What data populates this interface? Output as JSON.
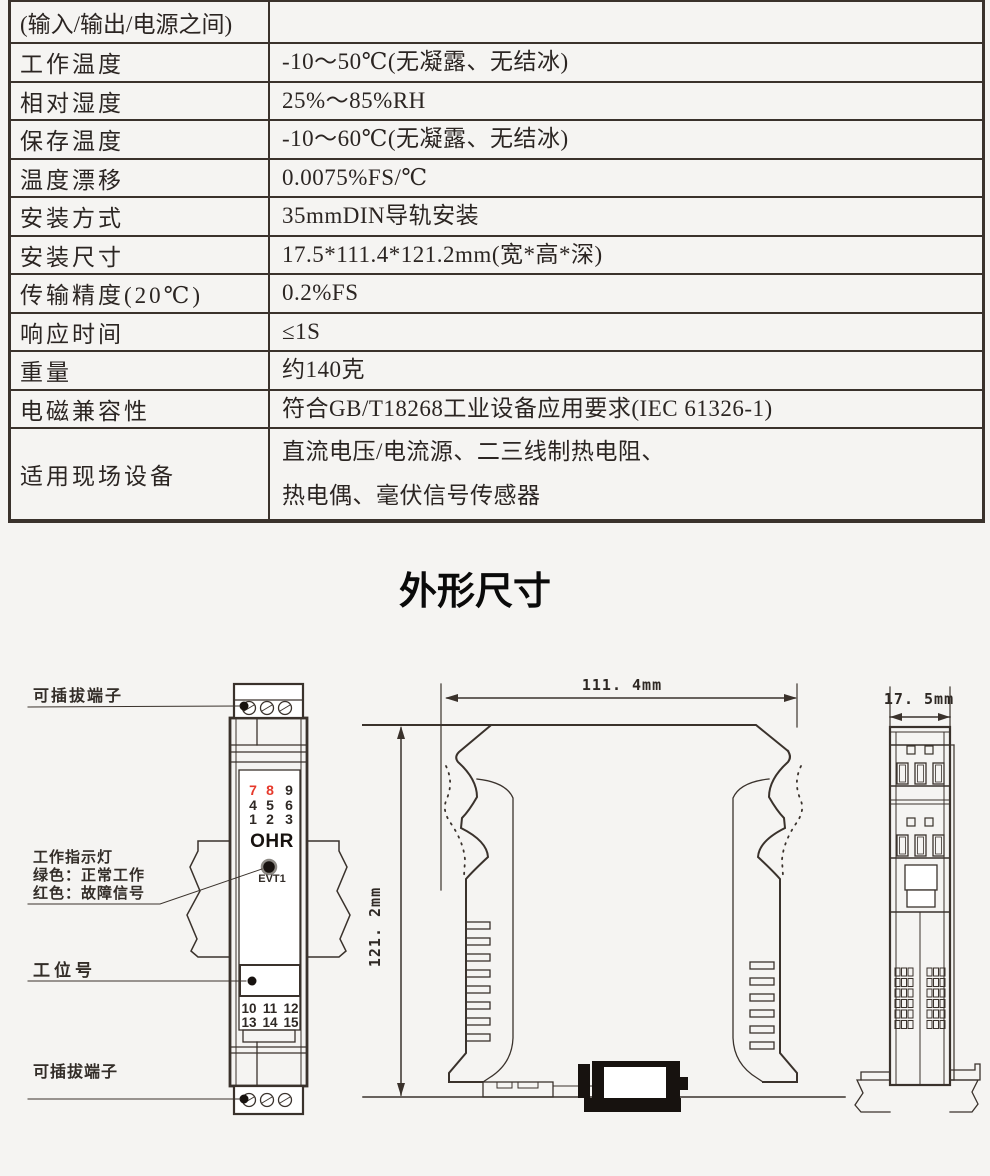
{
  "page": {
    "background": "#f5f4f2",
    "line_color": "#3a322c",
    "accent_red": "#e6392b"
  },
  "spec_table": {
    "rows": [
      {
        "label": "(输入/输出/电源之间)",
        "value": ""
      },
      {
        "label": "工作温度",
        "value": "-10～50℃(无凝露、无结冰)"
      },
      {
        "label": "相对湿度",
        "value": "25%～85%RH"
      },
      {
        "label": "保存温度",
        "value": "-10～60℃(无凝露、无结冰)"
      },
      {
        "label": "温度漂移",
        "value": "0.0075%FS/℃"
      },
      {
        "label": "安装方式",
        "value": "35mmDIN导轨安装"
      },
      {
        "label": "安装尺寸",
        "value": "17.5*111.4*121.2mm(宽*高*深)"
      },
      {
        "label": "传输精度(20℃)",
        "value": "0.2%FS"
      },
      {
        "label": "响应时间",
        "value": "≤1S"
      },
      {
        "label": "重量",
        "value": "约140克"
      },
      {
        "label": "电磁兼容性",
        "value": "符合GB/T18268工业设备应用要求(IEC 61326-1)"
      },
      {
        "label": "适用现场设备",
        "value": "直流电压/电流源、二三线制热电阻、\n热电偶、毫伏信号传感器"
      }
    ]
  },
  "section_title": "外形尺寸",
  "diagram": {
    "labels": {
      "pluggable_terminal_top": "可插拔端子",
      "indicator_title": "工作指示灯",
      "indicator_green": "绿色：正常工作",
      "indicator_red": "红色：故障信号",
      "station_tag": "工位号",
      "pluggable_terminal_bottom": "可插拔端子"
    },
    "device": {
      "brand": "OHR",
      "led_label": "EVT1",
      "top_terminals": [
        "7",
        "8",
        "9",
        "4",
        "5",
        "6",
        "1",
        "2",
        "3"
      ],
      "red_terminal_numbers": [
        "7",
        "8"
      ],
      "bottom_terminals": [
        "10",
        "11",
        "12",
        "13",
        "14",
        "15"
      ]
    },
    "dimensions": {
      "width_label": "111. 4mm",
      "height_label": "121. 2mm",
      "depth_label": "17. 5mm"
    }
  }
}
